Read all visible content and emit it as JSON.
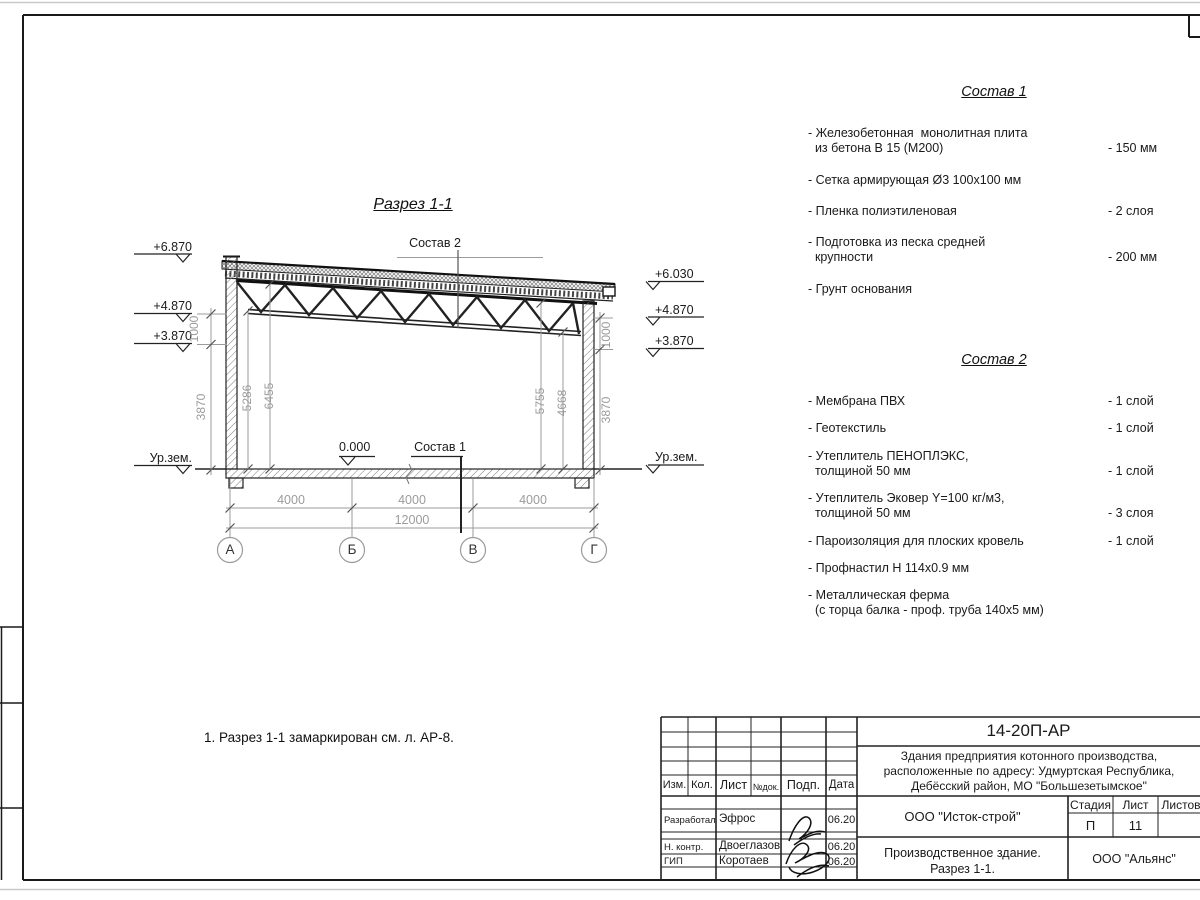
{
  "drawing": {
    "section_title": "Разрез 1-1",
    "note": "1. Разрез 1-1 замаркирован см. л. АР-8.",
    "callout_sostav1": "Состав 1",
    "callout_sostav2": "Состав 2",
    "zero_level": "0.000",
    "ground_level": "Ур.зем.",
    "elev_left": {
      "e1": "+6.870",
      "e2": "+4.870",
      "e3": "+3.870"
    },
    "elev_right": {
      "e1": "+6.030",
      "e2": "+4.870",
      "e3": "+3.870"
    },
    "dim": {
      "d1000": "1000",
      "d3870": "3870",
      "d5286": "5286",
      "d6455": "6455",
      "d5755": "5755",
      "d4668": "4668",
      "d4000": "4000",
      "d12000": "12000"
    },
    "axes": [
      "А",
      "Б",
      "В",
      "Г"
    ]
  },
  "sostav1": {
    "title": "Состав 1",
    "items": [
      {
        "name": "- Железобетонная  монолитная плита\n  из бетона В 15 (М200)",
        "value": "- 150 мм"
      },
      {
        "name": "- Сетка армирующая Ø3 100х100 мм",
        "value": ""
      },
      {
        "name": "- Пленка полиэтиленовая",
        "value": "- 2 слоя"
      },
      {
        "name": "- Подготовка из песка средней\n  крупности",
        "value": "- 200 мм"
      },
      {
        "name": "- Грунт основания",
        "value": ""
      }
    ]
  },
  "sostav2": {
    "title": "Состав 2",
    "items": [
      {
        "name": "- Мембрана ПВХ",
        "value": "- 1 слой"
      },
      {
        "name": "- Геотекстиль",
        "value": "- 1 слой"
      },
      {
        "name": "- Утеплитель ПЕНОПЛЭКС,\n  толщиной 50 мм",
        "value": "- 1 слой"
      },
      {
        "name": "- Утеплитель Эковер Y=100 кг/м3,\n  толщиной 50 мм",
        "value": "- 3 слоя"
      },
      {
        "name": "- Пароизоляция для плоских кровель",
        "value": "- 1 слой"
      },
      {
        "name": "- Профнастил Н 114х0.9 мм",
        "value": ""
      },
      {
        "name": "- Металлическая ферма\n  (с торца балка - проф. труба 140х5 мм)",
        "value": ""
      }
    ]
  },
  "titleblock": {
    "doc_code": "14-20П-АР",
    "object": "Здания предприятия котонного производства,\nрасположенные по адресу: Удмуртская Республика,\nДебёсский район, МО \"Большезетымское\"",
    "cols": {
      "izm": "Изм.",
      "kol": "Кол.",
      "list": "Лист",
      "ndoc": "№док.",
      "podp": "Подп.",
      "data": "Дата"
    },
    "rows": [
      {
        "role": "Разработал",
        "name": "Эфрос",
        "date": "06.20"
      },
      {
        "role": "Н. контр.",
        "name": "Двоеглазов",
        "date": "06.20"
      },
      {
        "role": "ГИП",
        "name": "Коротаев",
        "date": "06.20"
      }
    ],
    "org": "ООО \"Исток-строй\"",
    "stage_label": "Стадия",
    "sheet_label": "Лист",
    "sheets_label": "Листов",
    "stage": "П",
    "sheet": "11",
    "sheets": "",
    "subtitle": "Производственное здание.\nРазрез 1-1.",
    "contractor": "ООО \"Альянс\""
  }
}
